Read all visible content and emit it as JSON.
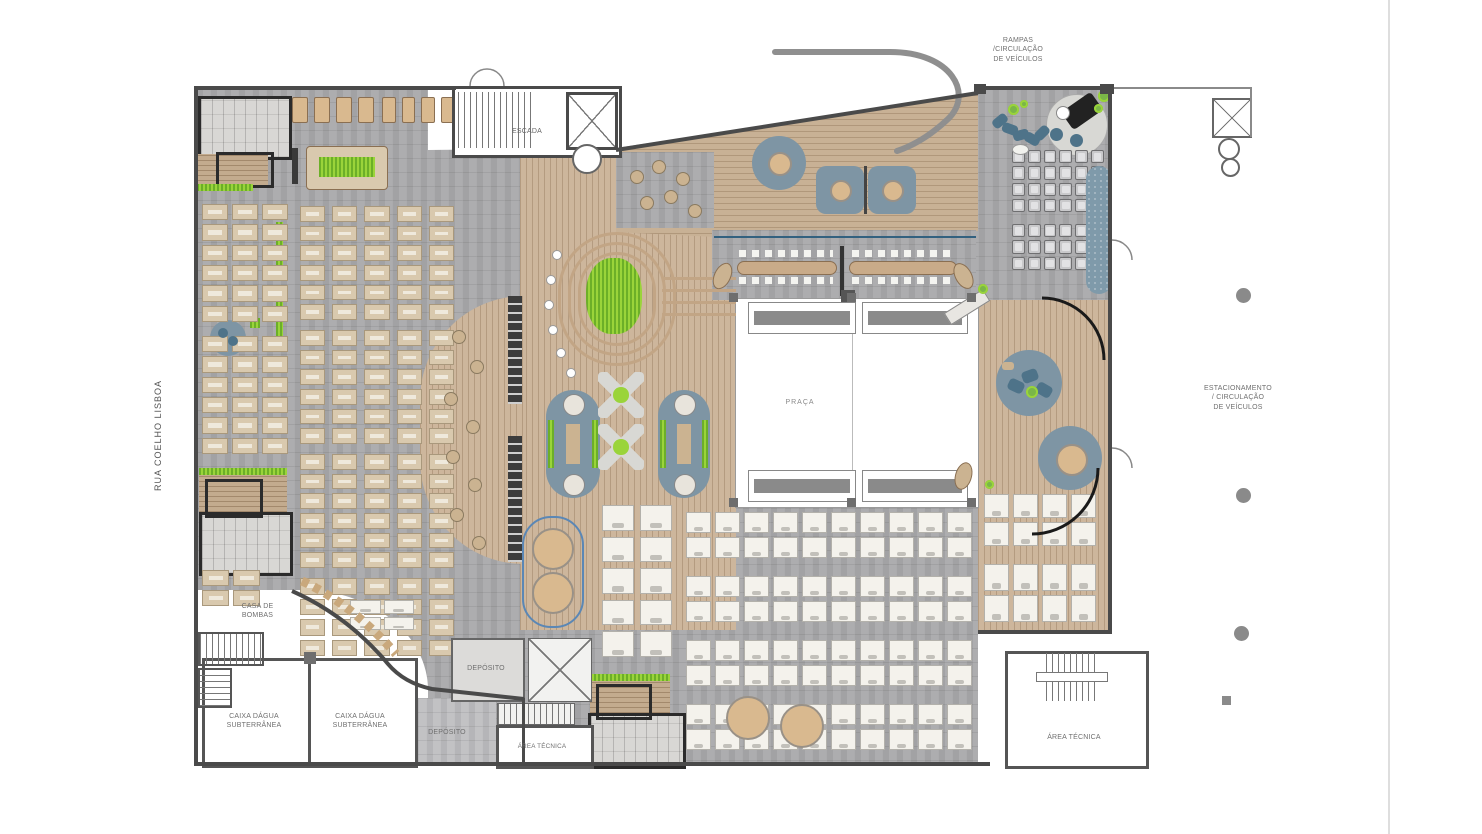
{
  "plan": {
    "street_label": "RUA COELHO LISBOA",
    "plaza_label": "PRAÇA",
    "stairs_label": "ESCADA",
    "annotations": {
      "ramps": [
        "RAMPAS",
        "/CIRCULAÇÃO",
        "DE VEÍCULOS"
      ],
      "parking": [
        "ESTACIONAMENTO",
        "/ CIRCULAÇÃO",
        "DE VEÍCULOS"
      ]
    },
    "rooms": {
      "pump_house": [
        "CASA DE",
        "BOMBAS"
      ],
      "water_tank": [
        "CAIXA DÁGUA",
        "SUBTERRÂNEA"
      ],
      "storage_upper": "DEPÓSITO",
      "storage_lower": "DEPÓSITO",
      "technical_center": "ÁREA TÉCNICA",
      "technical_right": "ÁREA TÉCNICA"
    },
    "colors": {
      "wall": "#4a4a4a",
      "carpet": "#a9a9ab",
      "wood": "#cdb69c",
      "deck": "#c3ab8e",
      "accent_green": "#9ad43a",
      "rug_blue": "#7e95a4",
      "seat_blue": "#4e7389",
      "desk_tan": "#d9c9ae",
      "desk_white": "#f4f2ec",
      "page_bg": "#ffffff"
    }
  }
}
